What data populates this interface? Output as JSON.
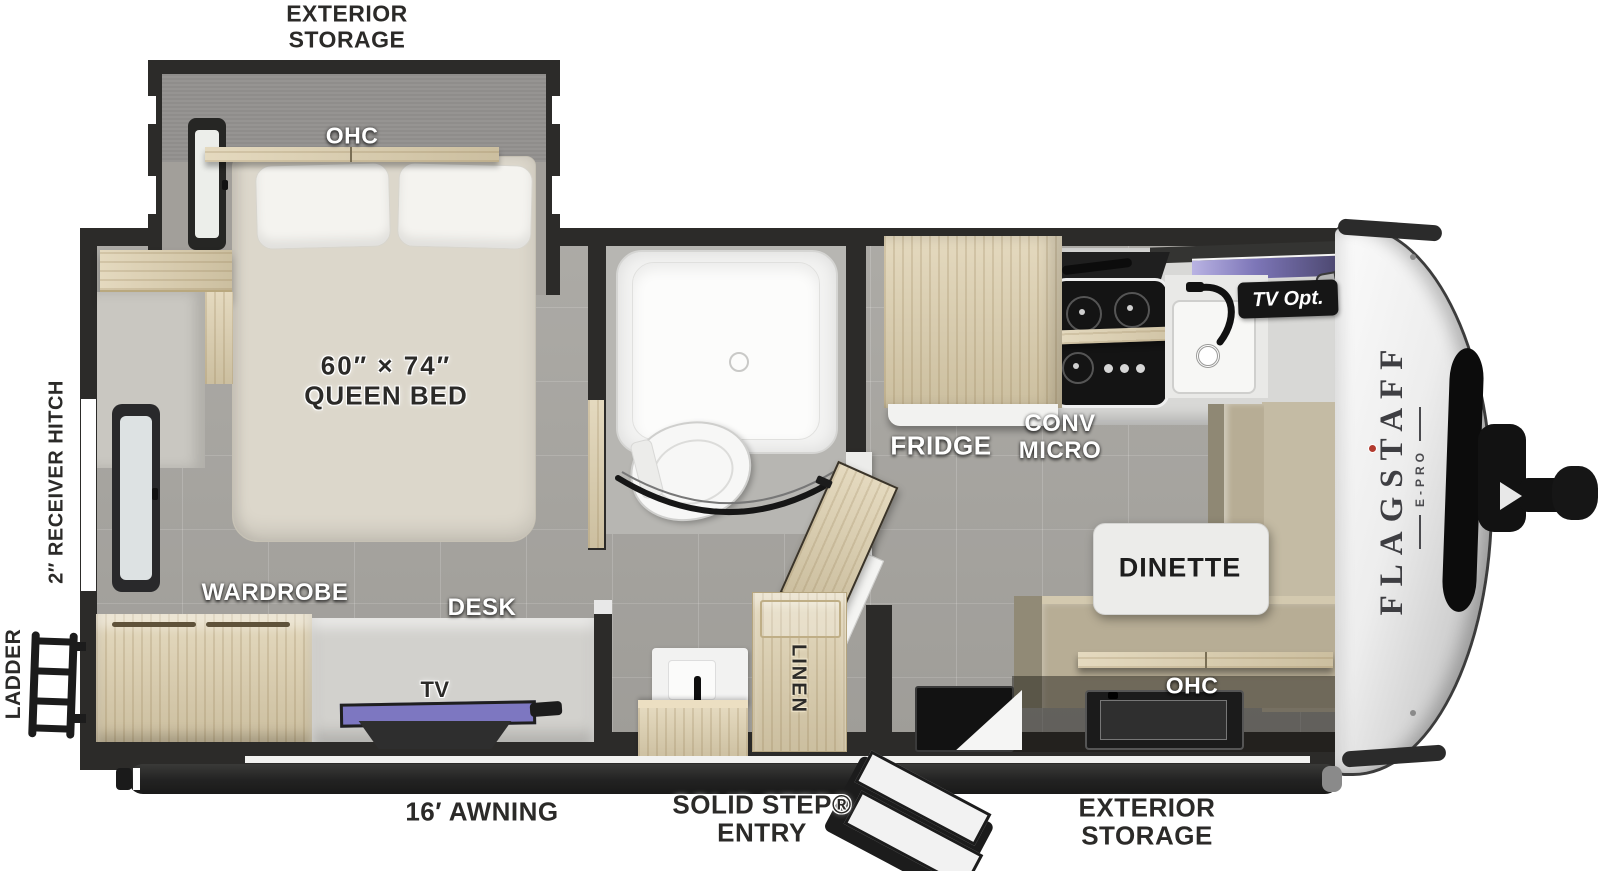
{
  "title": "Flagstaff E-Pro travel trailer floor plan",
  "brand": {
    "name": "FLAGSTAFF",
    "model": "E-PRO"
  },
  "labels": {
    "exterior_storage_top_1": "EXTERIOR",
    "exterior_storage_top_2": "STORAGE",
    "bedroom_ohc": "OHC",
    "bed_size": "60″ × 74″",
    "bed_type": "QUEEN BED",
    "receiver_hitch": "2″ RECEIVER HITCH",
    "ladder": "LADDER",
    "wardrobe": "WARDROBE",
    "desk": "DESK",
    "tv": "TV",
    "linen": "LINEN",
    "fridge": "FRIDGE",
    "conv_1": "CONV",
    "conv_2": "MICRO",
    "tv_opt": "TV Opt.",
    "dinette": "DINETTE",
    "dinette_ohc": "OHC",
    "awning": "16′ AWNING",
    "entry_1": "SOLID STEP®",
    "entry_2": "ENTRY",
    "exterior_storage_bottom_1": "EXTERIOR",
    "exterior_storage_bottom_2": "STORAGE"
  },
  "colors": {
    "wall": "#2c2b29",
    "wood": "#ddcfad",
    "floor": "#a7a5a0",
    "bench_tan": "#b7ad95",
    "window_accent": "#7d76b8",
    "tv_screen": "#7d77c1",
    "label_dark": "#2b2a28"
  }
}
